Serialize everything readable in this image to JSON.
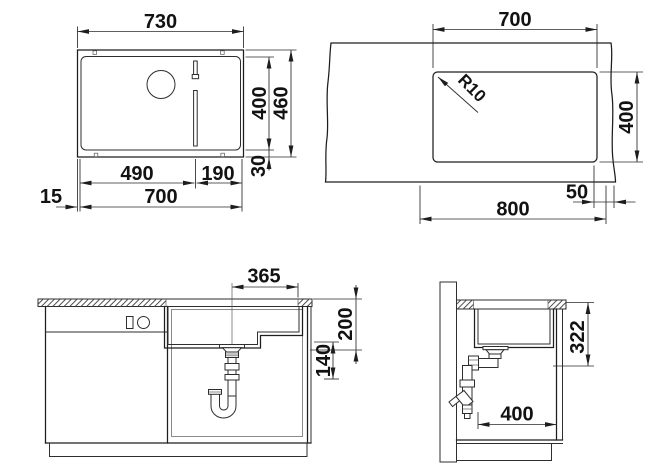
{
  "drawing": {
    "background": "#ffffff",
    "line_color": "#1d1d1d",
    "views": {
      "top_view": {
        "dims": {
          "outer_width": "730",
          "inner_height": "400",
          "outer_height": "460",
          "bottom_offset": "30",
          "bowl_section": "490",
          "ledge_section": "190",
          "inner_width": "700",
          "edge_offset": "15"
        }
      },
      "cutout_view": {
        "dims": {
          "cutout_width": "700",
          "corner_radius": "R10",
          "cutout_depth": "400",
          "edge_distance": "50",
          "min_cabinet_width": "800"
        }
      },
      "front_section_view": {
        "dims": {
          "drain_offset": "365",
          "bowl_depth": "200",
          "drain_clearance": "140"
        }
      },
      "side_section_view": {
        "dims": {
          "drain_height": "322",
          "wall_clearance": "400"
        }
      }
    }
  }
}
